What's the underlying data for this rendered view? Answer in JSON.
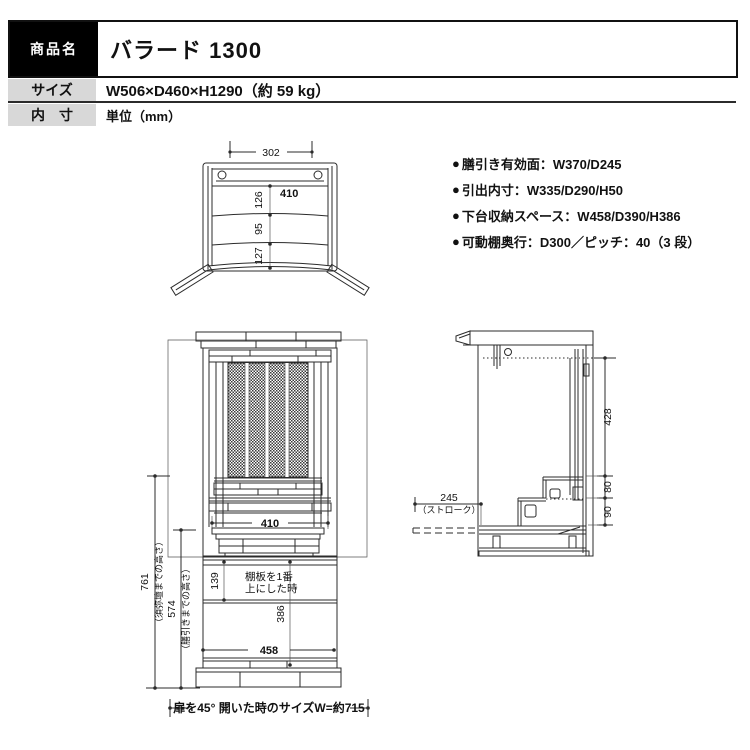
{
  "header": {
    "rows": [
      {
        "label": "商品名",
        "value": "バラード 1300"
      },
      {
        "label": "サイズ",
        "value": "W506×D460×H1290（約 59 kg）"
      },
      {
        "label": "内　寸",
        "value": "単位（mm）"
      }
    ]
  },
  "specs": {
    "bullet": "●",
    "items": [
      {
        "text": "膳引き有効面：W370/D245"
      },
      {
        "text": "引出内寸：W335/D290/H50"
      },
      {
        "text": "下台収納スペース：W458/D390/H386"
      },
      {
        "text": "可動棚奥行：D300／ピッチ：40（3 段）"
      }
    ]
  },
  "top_view": {
    "dims": {
      "w302": "302",
      "w410": "410",
      "d126": "126",
      "d95": "95",
      "d127": "127"
    }
  },
  "front_view": {
    "dims": {
      "w410": "410",
      "h139": "139",
      "h386": "386",
      "w458": "458",
      "h761": "761",
      "h761_note": "（須弥壇までの高さ）",
      "h574": "574",
      "h574_note": "（膳引きまでの高さ）",
      "shelf_note1": "棚板を1番",
      "shelf_note2": "上にした時",
      "open_width_note": "扉を45° 開いた時のサイズW=約715"
    }
  },
  "side_view": {
    "dims": {
      "h428": "428",
      "h80": "80",
      "h90": "90",
      "stroke": "245",
      "stroke_note": "（ストローク）"
    }
  },
  "colors": {
    "table_label_dark": "#000000",
    "table_label_gray": "#d8d8d8",
    "line": "#2b2b2b"
  }
}
